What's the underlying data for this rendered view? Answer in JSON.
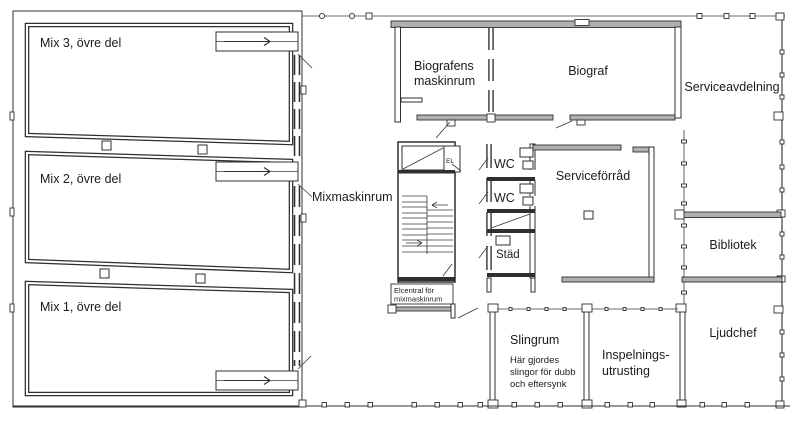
{
  "plan": {
    "colors": {
      "wall": "#2f2f2f",
      "wall_fill": "#b0b0b0",
      "background": "#ffffff",
      "text": "#1b1b1b"
    },
    "rooms": {
      "mix3": {
        "label": "Mix 3, övre del"
      },
      "mix2": {
        "label": "Mix 2, övre del"
      },
      "mix1": {
        "label": "Mix 1, övre del"
      },
      "mixmaskinrum": {
        "label": "Mixmaskinrum"
      },
      "biografens_maskinrum": {
        "line1": "Biografens",
        "line2": "maskinrum"
      },
      "biograf": {
        "label": "Biograf"
      },
      "serviceavdelning": {
        "label": "Serviceavdelning"
      },
      "wc_upper": {
        "label": "WC"
      },
      "wc_lower": {
        "label": "WC"
      },
      "stad": {
        "label": "Städ"
      },
      "serviceforrad": {
        "label": "Serviceförråd"
      },
      "bibliotek": {
        "label": "Bibliotek"
      },
      "ljudchef": {
        "label": "Ljudchef"
      },
      "inspelningsutrusting": {
        "line1": "Inspelnings-",
        "line2": "utrusting"
      },
      "slingrum": {
        "label": "Slingrum",
        "note1": "Här gjordes",
        "note2": "slingor för dubb",
        "note3": "och eftersynk"
      },
      "elcentral": {
        "line1": "Elcentral för",
        "line2": "mixmaskinrum"
      },
      "el_closet": {
        "label": "EL"
      }
    }
  }
}
